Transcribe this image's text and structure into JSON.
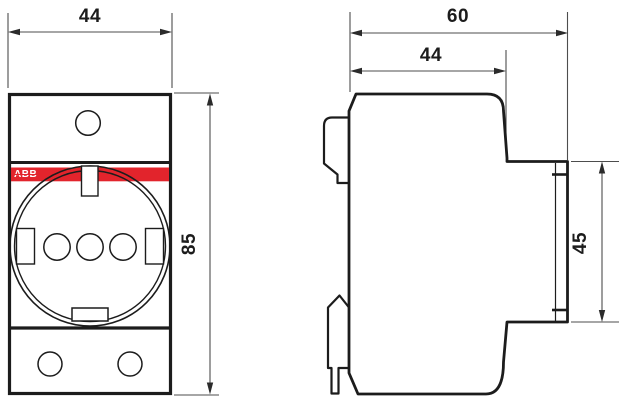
{
  "front_view": {
    "width_label": "44",
    "height_label": "85",
    "brand_label": "ABB"
  },
  "side_view": {
    "overall_depth_label": "60",
    "body_depth_label": "44",
    "front_height_label": "45"
  },
  "colors": {
    "accent_red": "#e2242c",
    "line": "#1c1c1c",
    "dim_line": "#4d4d4d"
  }
}
